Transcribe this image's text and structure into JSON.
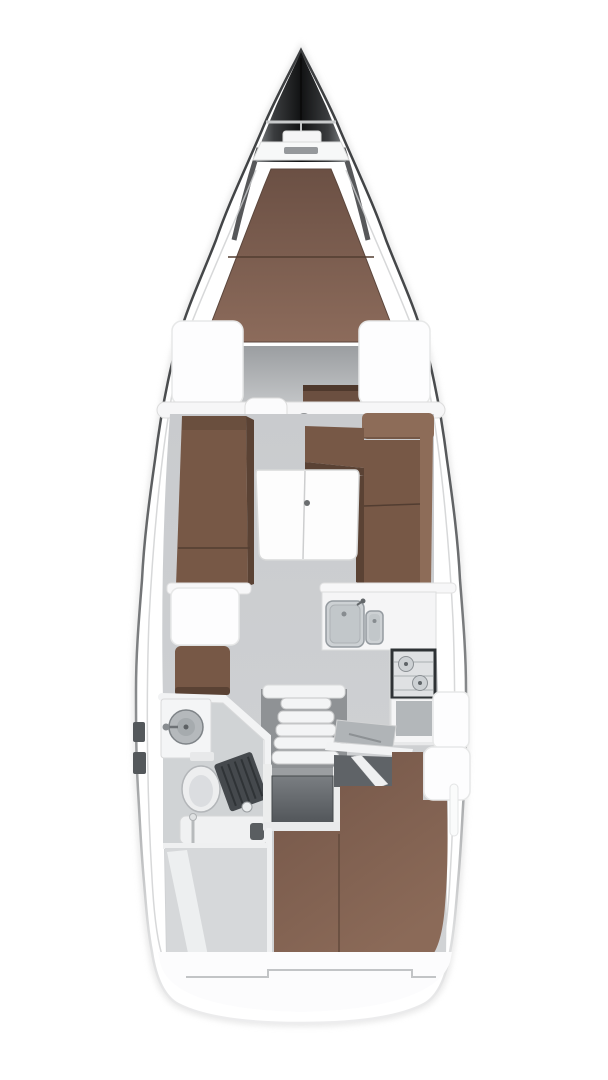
{
  "meta": {
    "diagram_type": "sailing-yacht-interior-deck-plan",
    "view": "top-down",
    "visible_text": []
  },
  "colors": {
    "background": "#ffffff",
    "hull_outline_dark": "#3c3e40",
    "hull_outline_fade": "#ededee",
    "bow_black": "#111213",
    "deck_white": "#fbfbfc",
    "hatch_white": "#fdfdfe",
    "furniture_white": "#f5f5f6",
    "table_white": "#fdfdfd",
    "floor_gray": "#c9cbce",
    "footwell_gray": "#9b9ea1",
    "companionway_gray": "#8f9295",
    "head_floor_gray": "#d0d3d5",
    "locker_gray": "#d6d8da",
    "cushion_brown": "#775846",
    "cushion_brown_light": "#8d6c58",
    "cushion_brown_dark": "#5a4234",
    "vberth_brown": "#8c6b5b",
    "aft_berth_brown": "#82604e",
    "step_brown": "#6b4f40",
    "steel_gray": "#cdd1d4",
    "steel_dark": "#959ba0",
    "stove_frame": "#2e3235",
    "engine_gray": "#53575b",
    "grate_dark": "#45494d",
    "porcelain": "#edeeef"
  },
  "features": [
    "hull",
    "bow",
    "bow-pulpit",
    "anchor-locker",
    "v-berth",
    "forward-footwell",
    "deck-hatch-port",
    "deck-hatch-starboard",
    "saloon-bulkhead",
    "cabin-door",
    "mast-post",
    "settee-port",
    "dinette-starboard",
    "saloon-table",
    "locker-port",
    "seat-port",
    "galley-counter",
    "galley-sink",
    "galley-sink-small",
    "galley-stove",
    "galley-cabinet",
    "locker-starboard",
    "head-compartment",
    "head-vanity",
    "head-basin",
    "toilet",
    "shower-grate",
    "head-shelf",
    "companionway-steps",
    "engine-compartment",
    "chart-table",
    "aft-berth",
    "aft-locker-port",
    "stern-platform"
  ]
}
